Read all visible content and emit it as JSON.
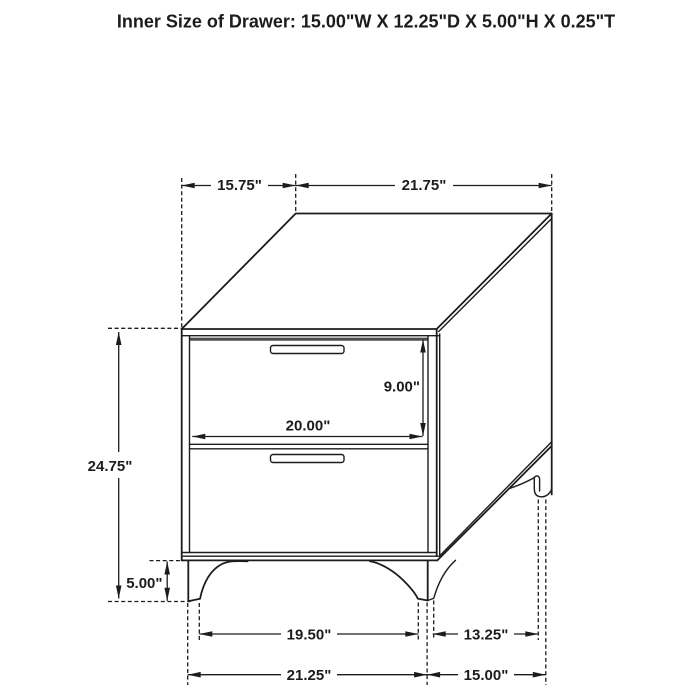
{
  "title": "Inner Size of Drawer: 15.00\"W X 12.25\"D X 5.00\"H X 0.25\"T",
  "labels": {
    "top_depth": "15.75\"",
    "top_width": "21.75\"",
    "overall_height": "24.75\"",
    "drawer_opening_height": "9.00\"",
    "drawer_opening_width": "20.00\"",
    "leg_height": "5.00\"",
    "front_feet_inner_span": "19.50\"",
    "side_feet_span": "13.25\"",
    "front_base_width": "21.25\"",
    "side_base_depth": "15.00\""
  },
  "colors": {
    "line": "#1c1c1c",
    "drawer_gap_shadow": "#4d4d4d",
    "background": "#ffffff"
  }
}
